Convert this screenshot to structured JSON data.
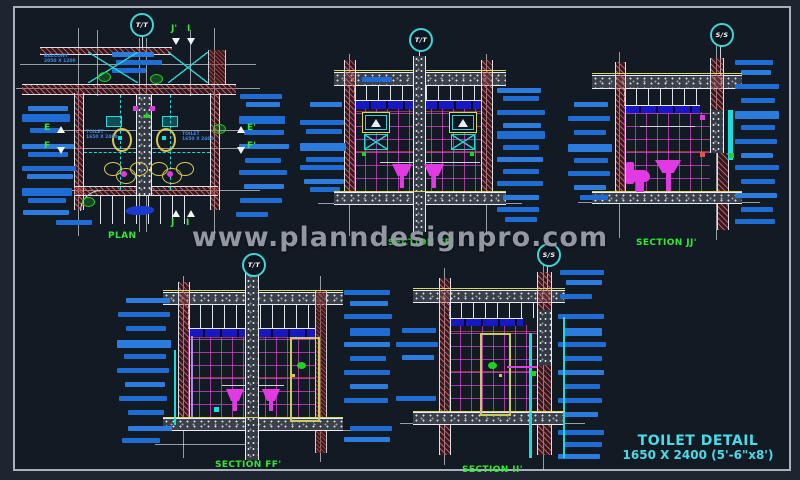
{
  "watermark_text": "www.planndesignpro.com",
  "title_block": {
    "name": "TOILET DETAIL",
    "size": "1650 X 2400 (5'-6\"x8')"
  },
  "views": {
    "plan": {
      "title": "PLAN",
      "marker": "T/T",
      "balcony_line1": "BALCONY",
      "balcony_line2": "2050 X 1200",
      "toilet_left_line1": "TOILET",
      "toilet_left_line2": "1650 X 2400",
      "toilet_right_line1": "TOILET",
      "toilet_right_line2": "1650 X 2400",
      "letters": {
        "e": "E",
        "f": "F",
        "e2": "E'",
        "f2": "F'",
        "j_top": "J'",
        "i_top": "I",
        "j_bot": "J",
        "i_bot": "I"
      }
    },
    "section_ee": {
      "title": "SECTION EE'",
      "marker": "T/T"
    },
    "section_jj": {
      "title": "SECTION JJ'",
      "marker": "S/S"
    },
    "section_ff": {
      "title": "SECTION FF'",
      "marker": "T/T"
    },
    "section_ii": {
      "title": "SECTION II'",
      "marker": "S/S"
    }
  },
  "colors": {
    "annotation_blue": "#1e6cd4",
    "cad_green": "#35e835",
    "cad_cyan": "#2ad4d4",
    "cad_magenta": "#e23ae2",
    "cad_yellow": "#d8d85a",
    "title_cyan": "#49dbe8",
    "hatch_red": "#e15252",
    "background": "#121a24"
  },
  "annotation_bars": {
    "plan_left": [
      [
        28,
        106,
        40
      ],
      [
        22,
        114,
        48,
        8
      ],
      [
        30,
        128,
        32
      ],
      [
        22,
        144,
        52
      ],
      [
        28,
        152,
        40
      ],
      [
        22,
        166,
        54
      ],
      [
        27,
        174,
        46
      ],
      [
        22,
        188,
        50,
        8
      ],
      [
        28,
        198,
        38
      ],
      [
        23,
        210,
        46
      ],
      [
        56,
        220,
        36
      ]
    ],
    "plan_right": [
      [
        240,
        94,
        42
      ],
      [
        246,
        102,
        34
      ],
      [
        239,
        116,
        46,
        8
      ],
      [
        244,
        130,
        40
      ],
      [
        239,
        144,
        50
      ],
      [
        245,
        158,
        36
      ],
      [
        239,
        170,
        48
      ],
      [
        244,
        184,
        40
      ],
      [
        240,
        198,
        42
      ],
      [
        236,
        212,
        32
      ]
    ],
    "plan_top": [
      [
        112,
        52,
        42
      ],
      [
        116,
        60,
        46
      ],
      [
        112,
        68,
        34
      ]
    ],
    "ee_left": [
      [
        310,
        102,
        32
      ],
      [
        300,
        120,
        44
      ],
      [
        306,
        129,
        36
      ],
      [
        300,
        143,
        46,
        8
      ],
      [
        306,
        157,
        38
      ],
      [
        300,
        165,
        44
      ],
      [
        304,
        179,
        40
      ],
      [
        310,
        187,
        30
      ],
      [
        362,
        77,
        30
      ]
    ],
    "ee_right": [
      [
        497,
        88,
        44
      ],
      [
        503,
        96,
        36
      ],
      [
        497,
        110,
        48
      ],
      [
        503,
        123,
        38
      ],
      [
        497,
        131,
        48,
        8
      ],
      [
        503,
        145,
        36
      ],
      [
        497,
        157,
        46
      ],
      [
        503,
        169,
        36
      ],
      [
        497,
        181,
        46
      ],
      [
        503,
        195,
        36
      ],
      [
        497,
        207,
        42
      ],
      [
        505,
        217,
        32
      ]
    ],
    "jj_left": [
      [
        574,
        102,
        34
      ],
      [
        568,
        116,
        42
      ],
      [
        574,
        130,
        32
      ],
      [
        568,
        144,
        44,
        8
      ],
      [
        574,
        158,
        34
      ],
      [
        568,
        171,
        42
      ],
      [
        574,
        185,
        32
      ],
      [
        580,
        195,
        28
      ]
    ],
    "jj_right": [
      [
        735,
        60,
        38
      ],
      [
        741,
        70,
        30
      ],
      [
        735,
        84,
        44
      ],
      [
        741,
        98,
        34
      ],
      [
        735,
        111,
        44,
        8
      ],
      [
        741,
        125,
        34
      ],
      [
        735,
        139,
        42
      ],
      [
        741,
        153,
        32
      ],
      [
        735,
        165,
        44
      ],
      [
        741,
        179,
        34
      ],
      [
        735,
        193,
        42
      ],
      [
        741,
        207,
        32
      ],
      [
        735,
        219,
        40
      ]
    ],
    "ff_left": [
      [
        126,
        298,
        44
      ],
      [
        118,
        312,
        52
      ],
      [
        126,
        326,
        40
      ],
      [
        117,
        340,
        54,
        8
      ],
      [
        124,
        354,
        42
      ],
      [
        117,
        368,
        52
      ],
      [
        125,
        382,
        40
      ],
      [
        119,
        396,
        48
      ],
      [
        128,
        410,
        36
      ],
      [
        128,
        426,
        44
      ],
      [
        122,
        438,
        38
      ]
    ],
    "ff_right": [
      [
        344,
        290,
        46
      ],
      [
        350,
        301,
        38
      ],
      [
        344,
        314,
        48
      ],
      [
        350,
        328,
        40,
        8
      ],
      [
        344,
        342,
        46
      ],
      [
        350,
        356,
        36
      ],
      [
        344,
        370,
        46
      ],
      [
        350,
        384,
        38
      ],
      [
        344,
        398,
        44
      ],
      [
        350,
        426,
        42
      ],
      [
        344,
        437,
        46
      ]
    ],
    "ii_left": [
      [
        402,
        328,
        34
      ],
      [
        396,
        342,
        42
      ],
      [
        402,
        355,
        32
      ],
      [
        396,
        396,
        40
      ]
    ],
    "ii_right": [
      [
        560,
        270,
        44
      ],
      [
        566,
        280,
        36
      ],
      [
        560,
        294,
        32
      ],
      [
        558,
        314,
        46
      ],
      [
        564,
        328,
        38,
        8
      ],
      [
        558,
        342,
        48
      ],
      [
        564,
        356,
        38
      ],
      [
        558,
        370,
        46
      ],
      [
        564,
        384,
        36
      ],
      [
        558,
        398,
        44
      ],
      [
        564,
        412,
        34
      ],
      [
        558,
        430,
        46
      ],
      [
        564,
        442,
        38
      ],
      [
        558,
        454,
        42
      ]
    ]
  }
}
